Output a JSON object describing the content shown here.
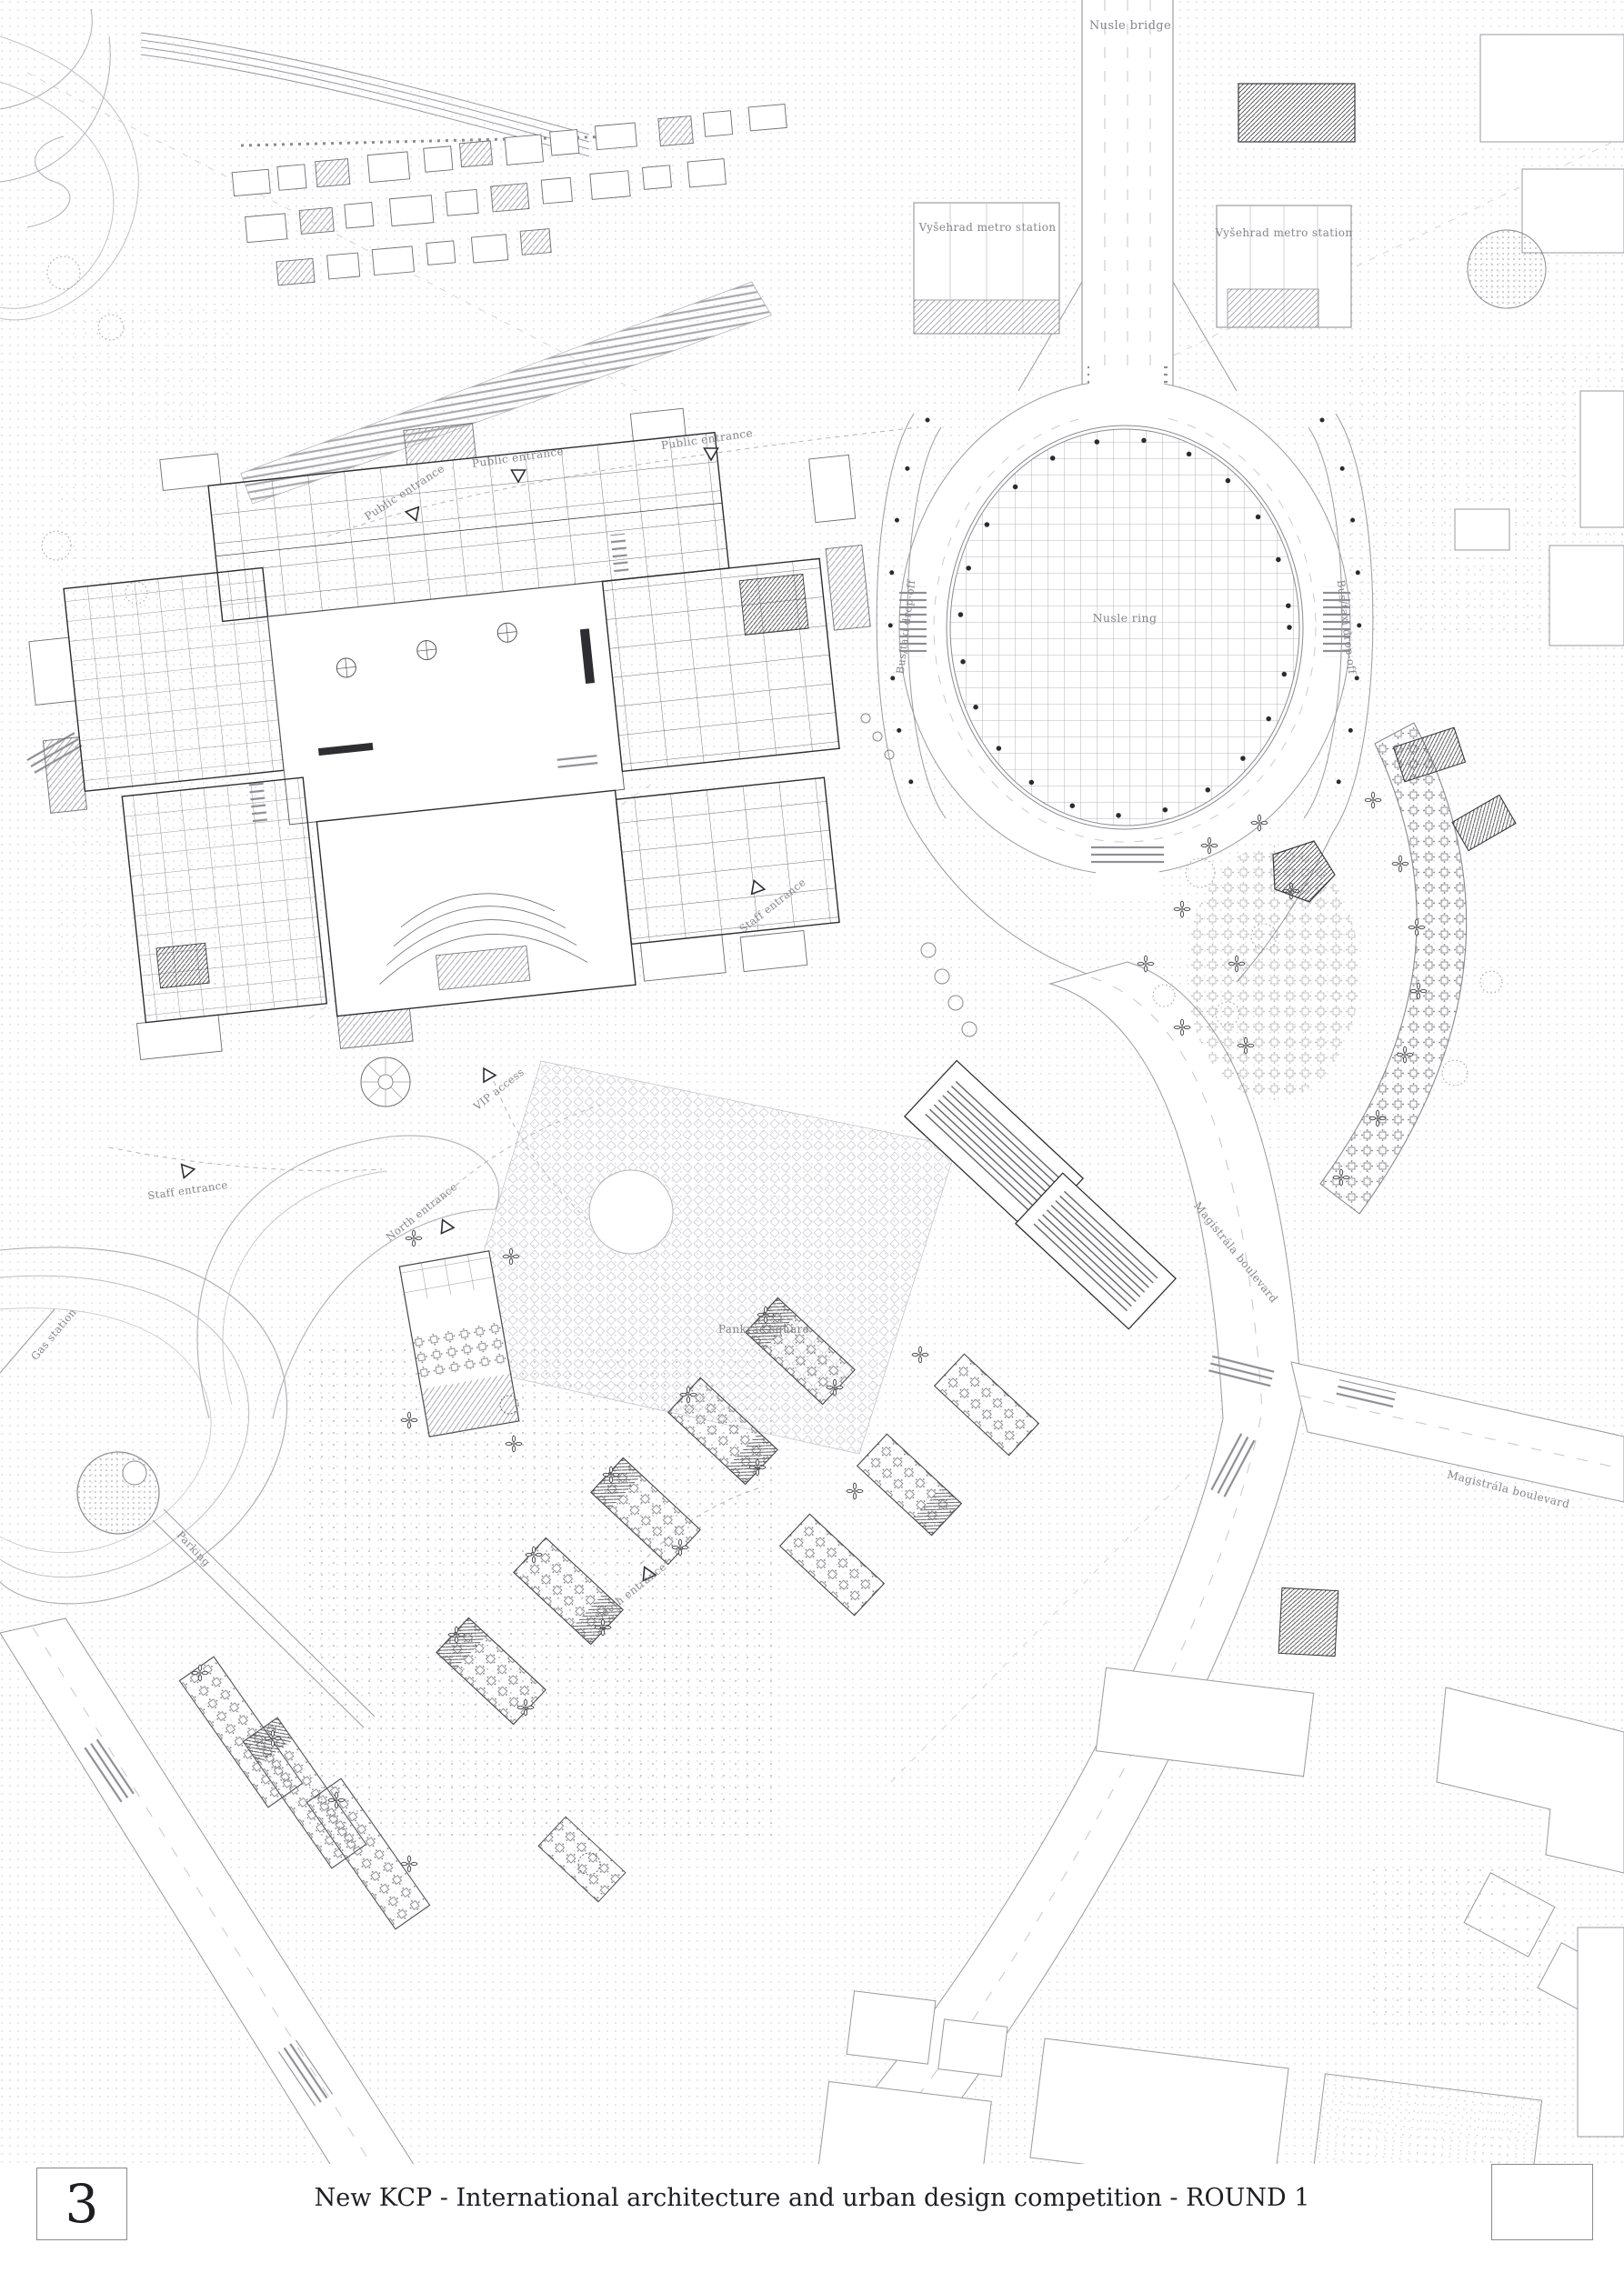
{
  "titlebar": {
    "panel_number": "3",
    "title": "New KCP - International architecture and urban design competition - ROUND 1"
  },
  "map_labels": {
    "nusle_bridge": "Nusle bridge",
    "metro_station_west": "Vyšehrad metro station",
    "metro_station_east": "Vyšehrad metro station",
    "nusle_ring": "Nusle ring",
    "bus_taxi_dropoff_west": "Bus/taxi drop-off",
    "bus_taxi_dropoff_east": "Bus/taxi drop-off",
    "public_entrance_west": "Public entrance",
    "public_entrance_center": "Public entrance",
    "public_entrance_east": "Public entrance",
    "staff_entrance_north": "Staff entrance",
    "staff_entrance_south": "Staff entrance",
    "vip_access": "VIP access",
    "north_entrance": "North entrance",
    "south_entrance": "South entrance",
    "square": "Pankrác square",
    "magistrala_west": "Magistrála boulevard",
    "magistrala_east": "Magistrála boulevard",
    "gas_station": "Gas station",
    "parking": "Parking"
  },
  "colors": {
    "paper": "#ffffff",
    "ink_dark": "#2e2e32",
    "ink_mid": "#6e6e74",
    "ink_light": "#9a9aa0",
    "label_grey": "#85858b"
  }
}
